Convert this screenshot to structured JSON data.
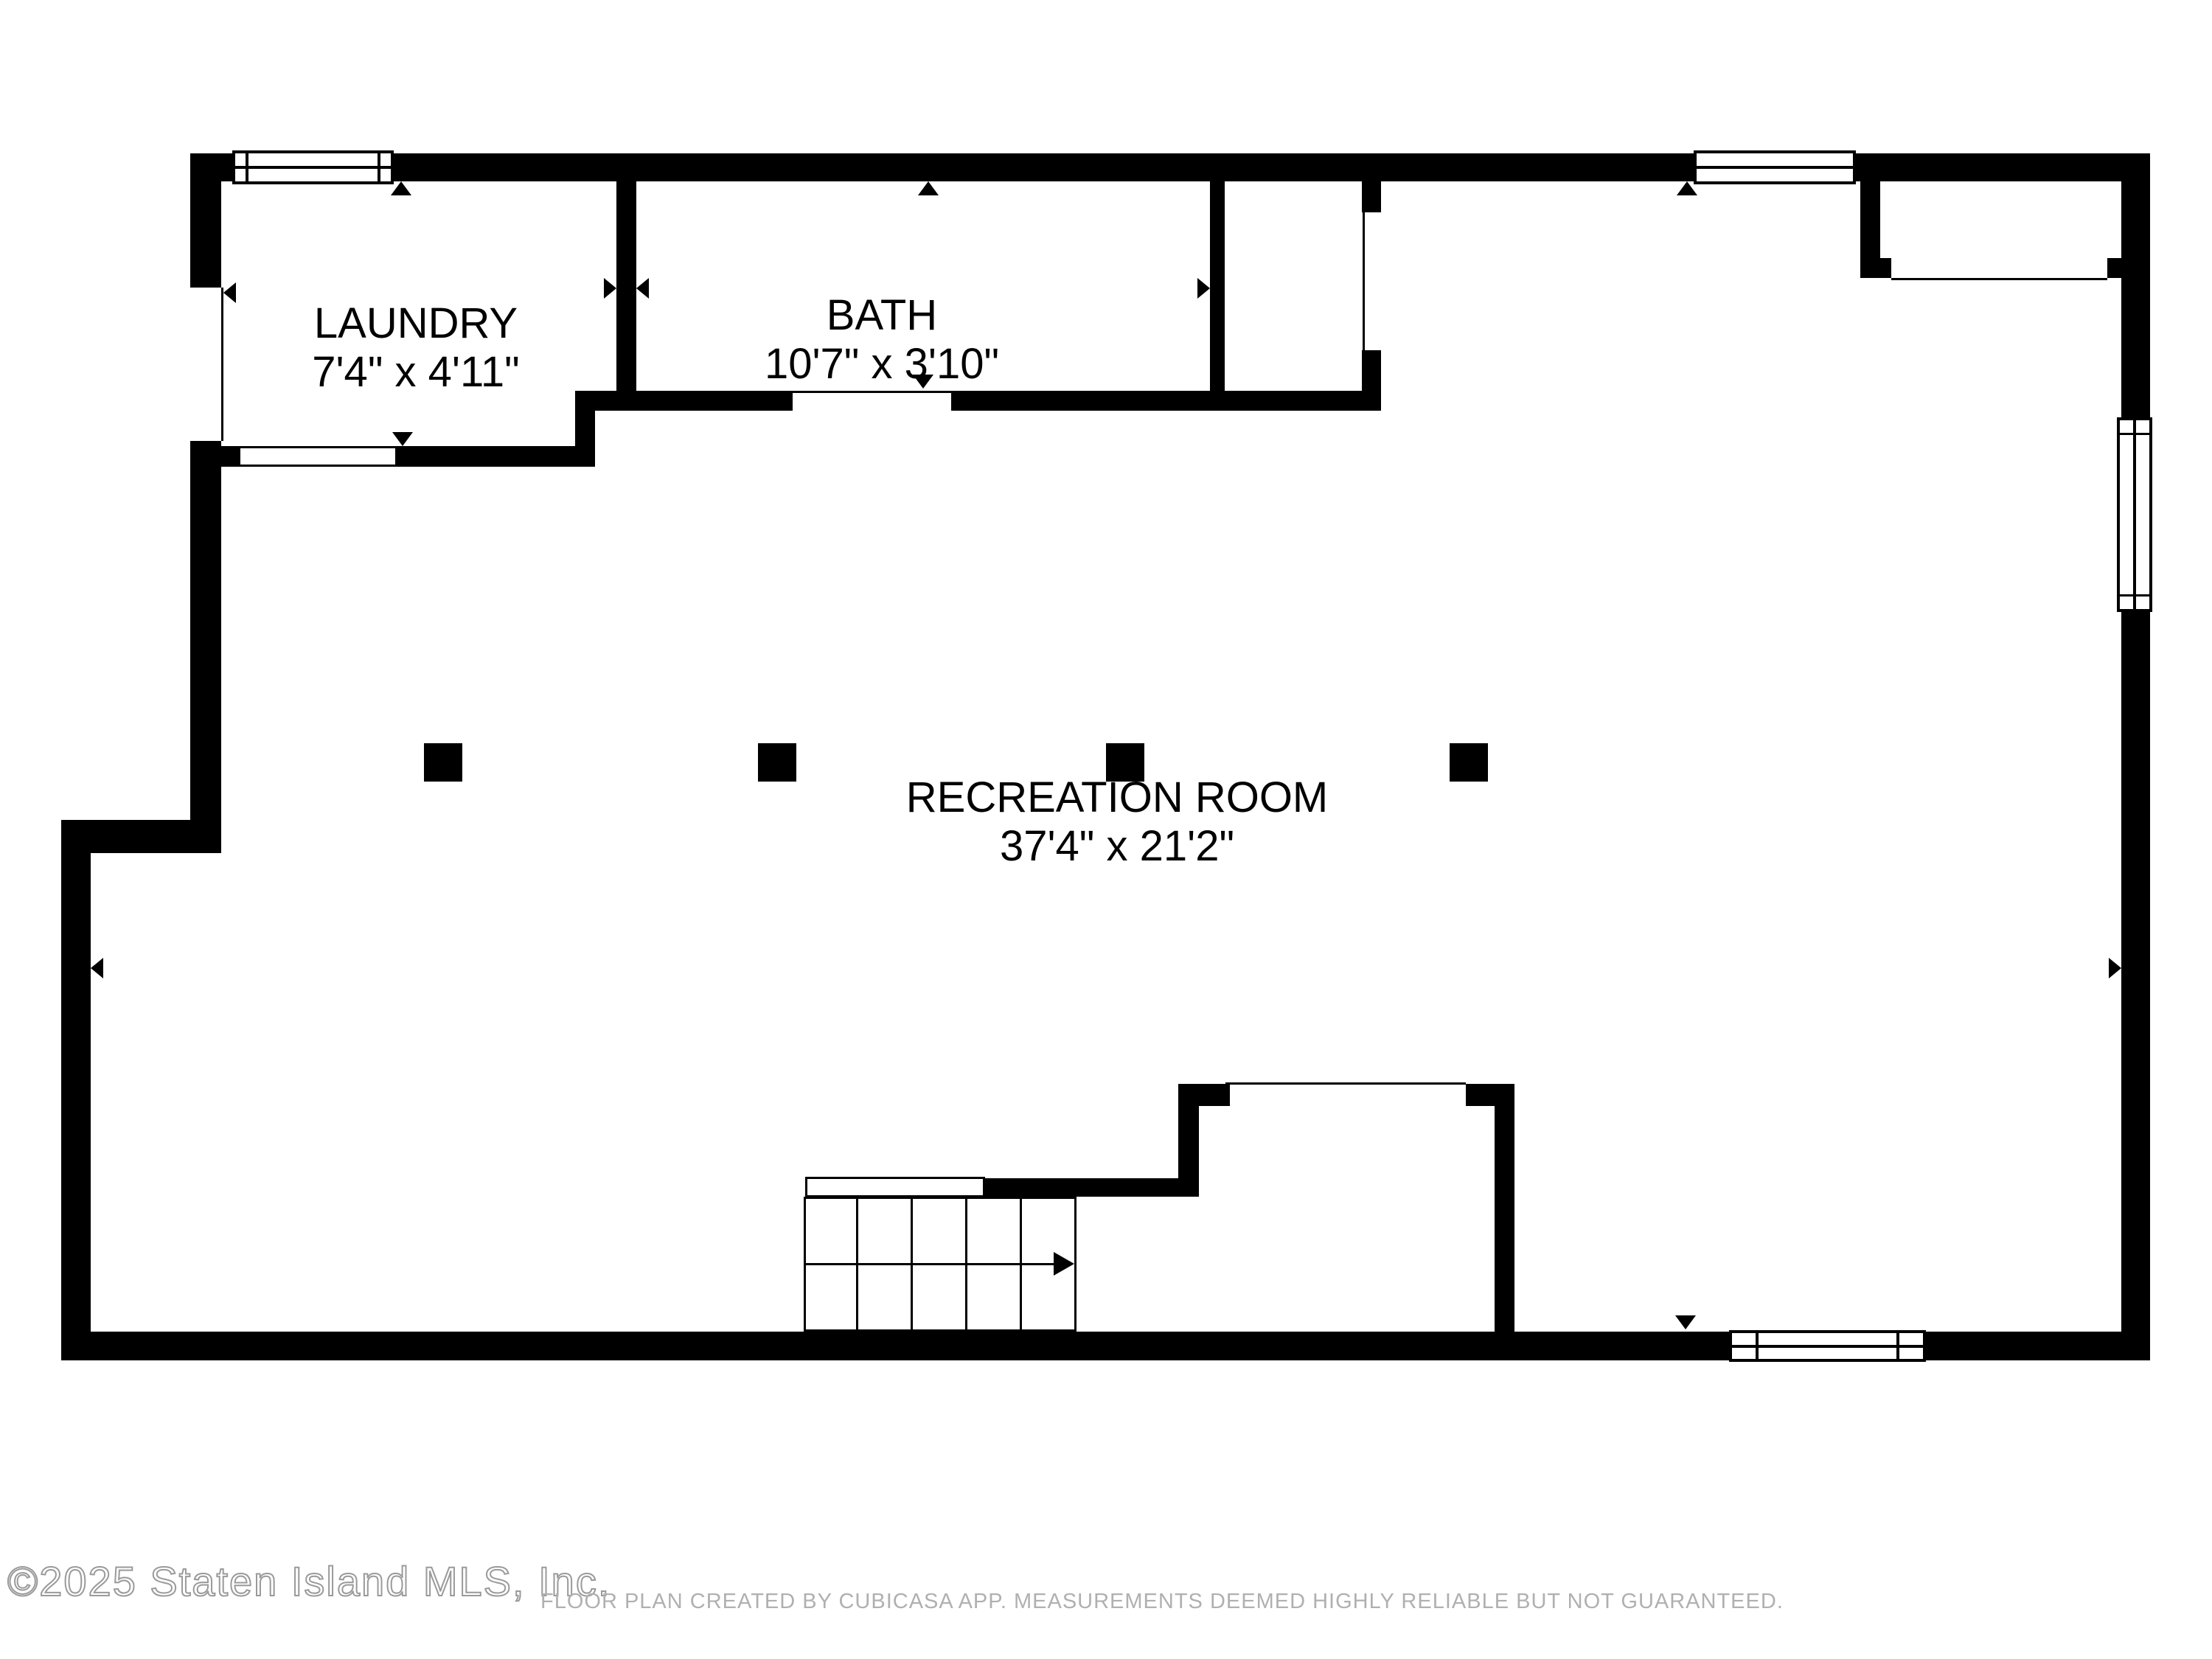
{
  "floorplan": {
    "rooms": [
      {
        "name": "LAUNDRY",
        "dimensions": "7'4\" x 4'11\""
      },
      {
        "name": "BATH",
        "dimensions": "10'7\" x 3'10\""
      },
      {
        "name": "RECREATION ROOM",
        "dimensions": "37'4\" x 21'2\""
      }
    ],
    "features": [
      "stairs-up",
      "windows",
      "door-openings",
      "support-columns"
    ]
  },
  "footer": {
    "watermark": "©2025 Staten Island MLS, Inc.",
    "disclaimer": "FLOOR PLAN CREATED BY CUBICASA APP. MEASUREMENTS DEEMED HIGHLY RELIABLE BUT NOT GUARANTEED."
  },
  "colors": {
    "wall": "#000000",
    "background": "#ffffff",
    "disclaimer_text": "#b0b0b0",
    "watermark_fill": "#ffffff",
    "watermark_outline": "#9a9a9a"
  }
}
